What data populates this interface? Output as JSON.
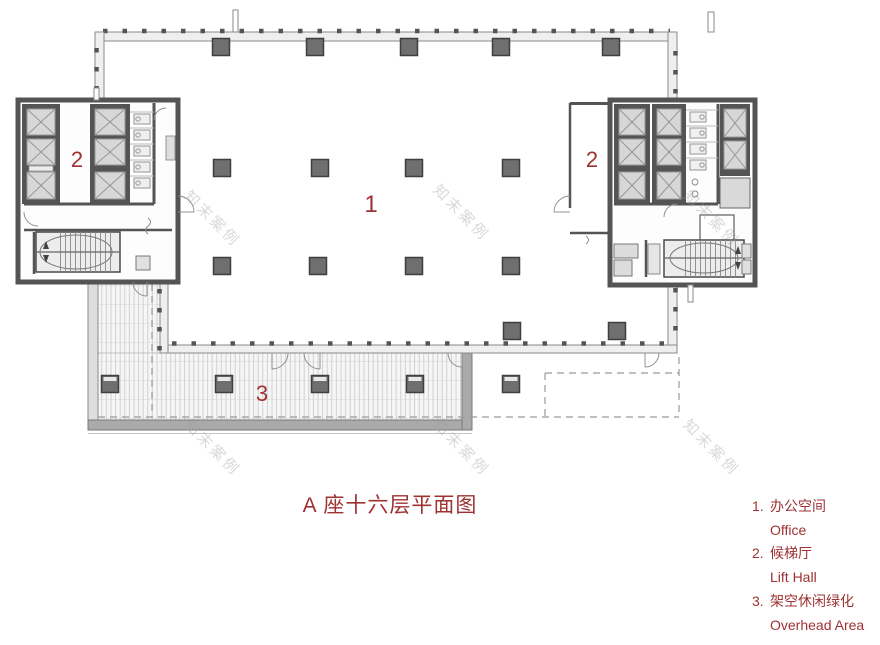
{
  "title": "A 座十六层平面图",
  "watermark": {
    "text": "知末案例"
  },
  "plan": {
    "office_label": "1",
    "lift_hall_left_label": "2",
    "lift_hall_right_label": "2",
    "terrace_label": "3"
  },
  "legend": {
    "items": [
      {
        "num": "1.",
        "zh": "办公空间",
        "en": "Office"
      },
      {
        "num": "2.",
        "zh": "候梯厅",
        "en": "Lift Hall"
      },
      {
        "num": "3.",
        "zh": "架空休闲绿化",
        "en": "Overhead Area"
      }
    ]
  },
  "colors": {
    "accent_red": "#9E3132",
    "wall_dark": "#545454",
    "column_fill": "#6F6F6F",
    "watermark_gray": "#9A9A9A"
  }
}
